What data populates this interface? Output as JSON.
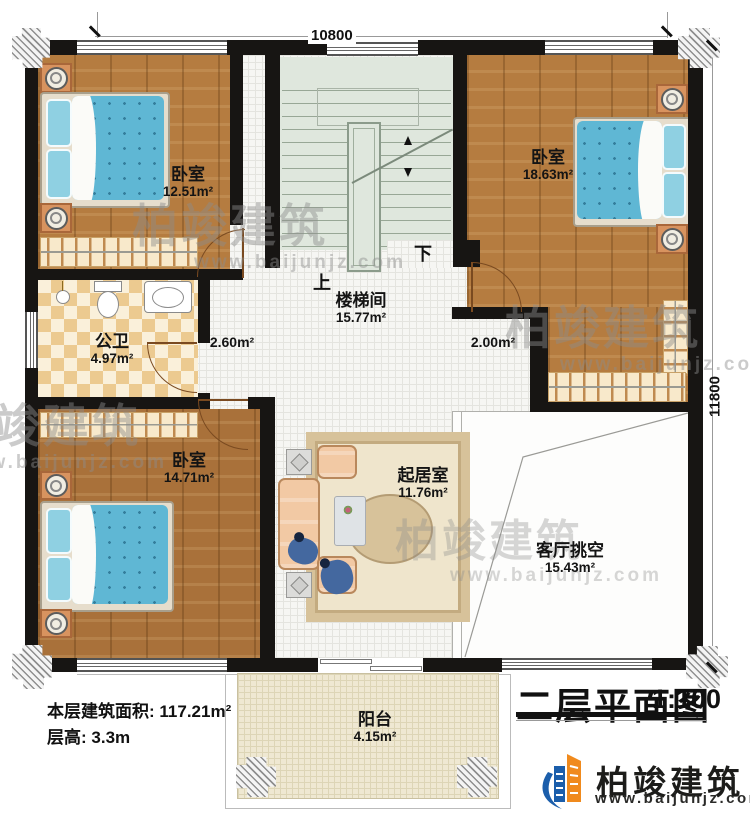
{
  "title": {
    "name": "二层平面图",
    "scale": "1:100"
  },
  "dimensions": {
    "top": "10800",
    "right": "11800"
  },
  "rooms": {
    "bedroom_tl": {
      "name": "卧室",
      "area": "12.51m²"
    },
    "bedroom_tr": {
      "name": "卧室",
      "area": "18.63m²"
    },
    "bathroom": {
      "name": "公卫",
      "area": "4.97m²"
    },
    "stairwell": {
      "name": "楼梯间",
      "area": "15.77m²"
    },
    "bedroom_bl": {
      "name": "卧室",
      "area": "14.71m²"
    },
    "living": {
      "name": "起居室",
      "area": "11.76m²"
    },
    "void": {
      "name": "客厅挑空",
      "area": "15.43m²"
    },
    "balcony": {
      "name": "阳台",
      "area": "4.15m²"
    }
  },
  "hall": {
    "left_area": "2.60m²",
    "right_area": "2.00m²"
  },
  "stairs": {
    "up": "上",
    "down": "下"
  },
  "footer": {
    "area_label": "本层建筑面积:",
    "area_value": "117.21m²",
    "height_label": "层高:",
    "height_value": "3.3m"
  },
  "brand": {
    "name": "柏竣建筑",
    "website": "www.baijunjz.com"
  },
  "watermark": {
    "text": "柏竣建筑",
    "website": "www.baijunjz.com"
  },
  "colors": {
    "wall": "#171513",
    "wood_floor": "#b57c40",
    "bed_blue": "#5fb7d4",
    "stair_green": "#dfe7dd",
    "bathroom_tile": "#ecca90",
    "balcony_floor": "#efe8d2",
    "brand_blue": "#1b5eab",
    "brand_orange": "#f08a1d"
  }
}
